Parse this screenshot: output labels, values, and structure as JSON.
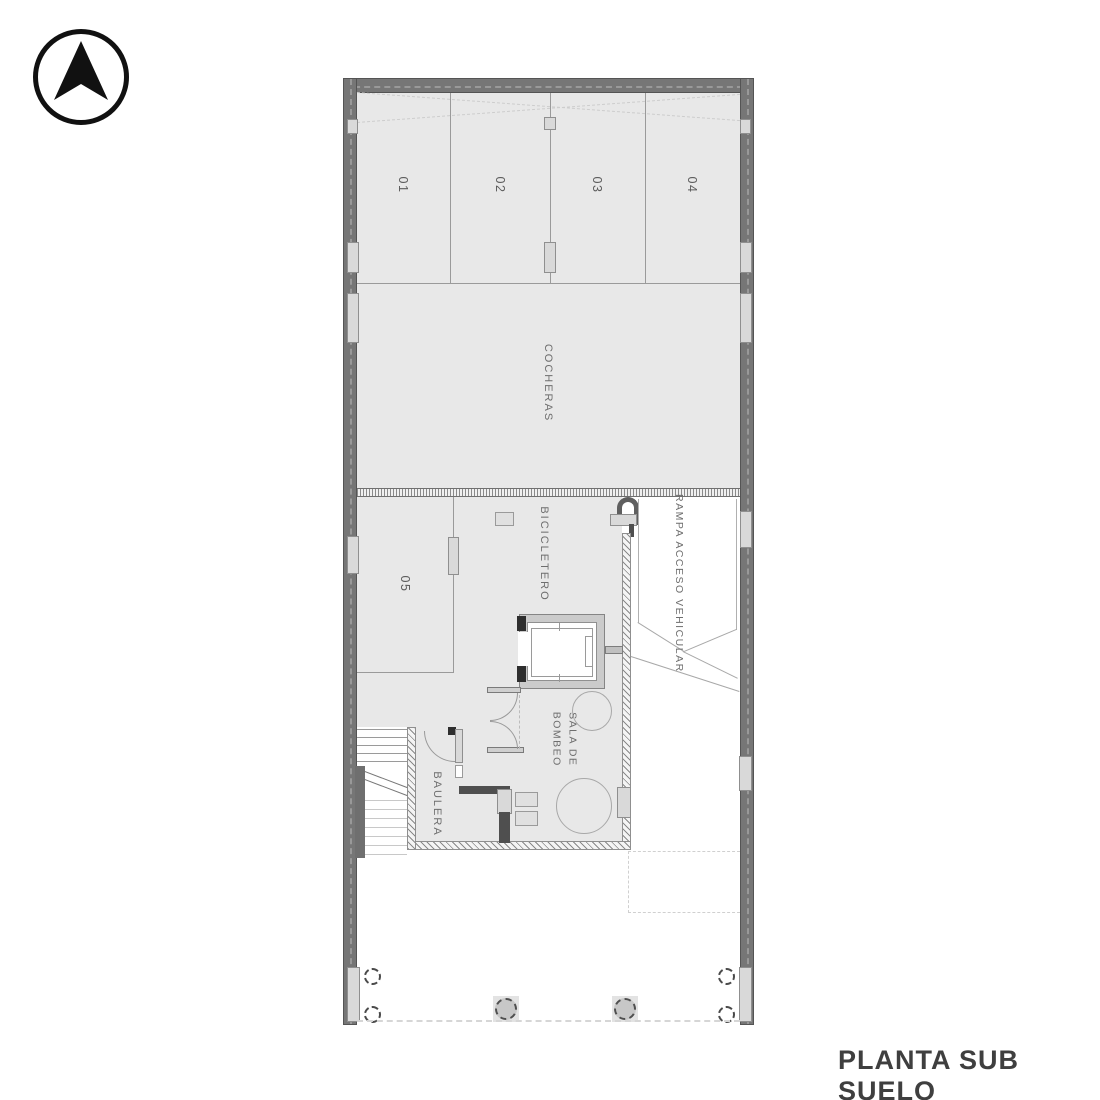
{
  "page_title": "PLANTA SUB SUELO",
  "north_arrow": {
    "icon": "north-arrow-icon"
  },
  "floor_plan": {
    "stalls": [
      {
        "label": "01"
      },
      {
        "label": "02"
      },
      {
        "label": "03"
      },
      {
        "label": "04"
      },
      {
        "label": "05"
      }
    ],
    "areas": {
      "cocheras": {
        "label": "COCHERAS"
      },
      "bicicletero": {
        "label": "BICICLETERO"
      },
      "rampa": {
        "label": "RAMPA ACCESO VEHICULAR"
      },
      "sala_de_bombeo": {
        "label": "SALA DE BOMBEO"
      },
      "baulera": {
        "label": "BAULERA"
      }
    }
  },
  "colors": {
    "wall": "#767676",
    "floor": "#e8e8e8",
    "line": "#9a9a9a",
    "dark_wall": "#4f4f4f",
    "label_text": "#6e6e6e",
    "title_text": "#3f3f3f",
    "background": "#ffffff"
  }
}
